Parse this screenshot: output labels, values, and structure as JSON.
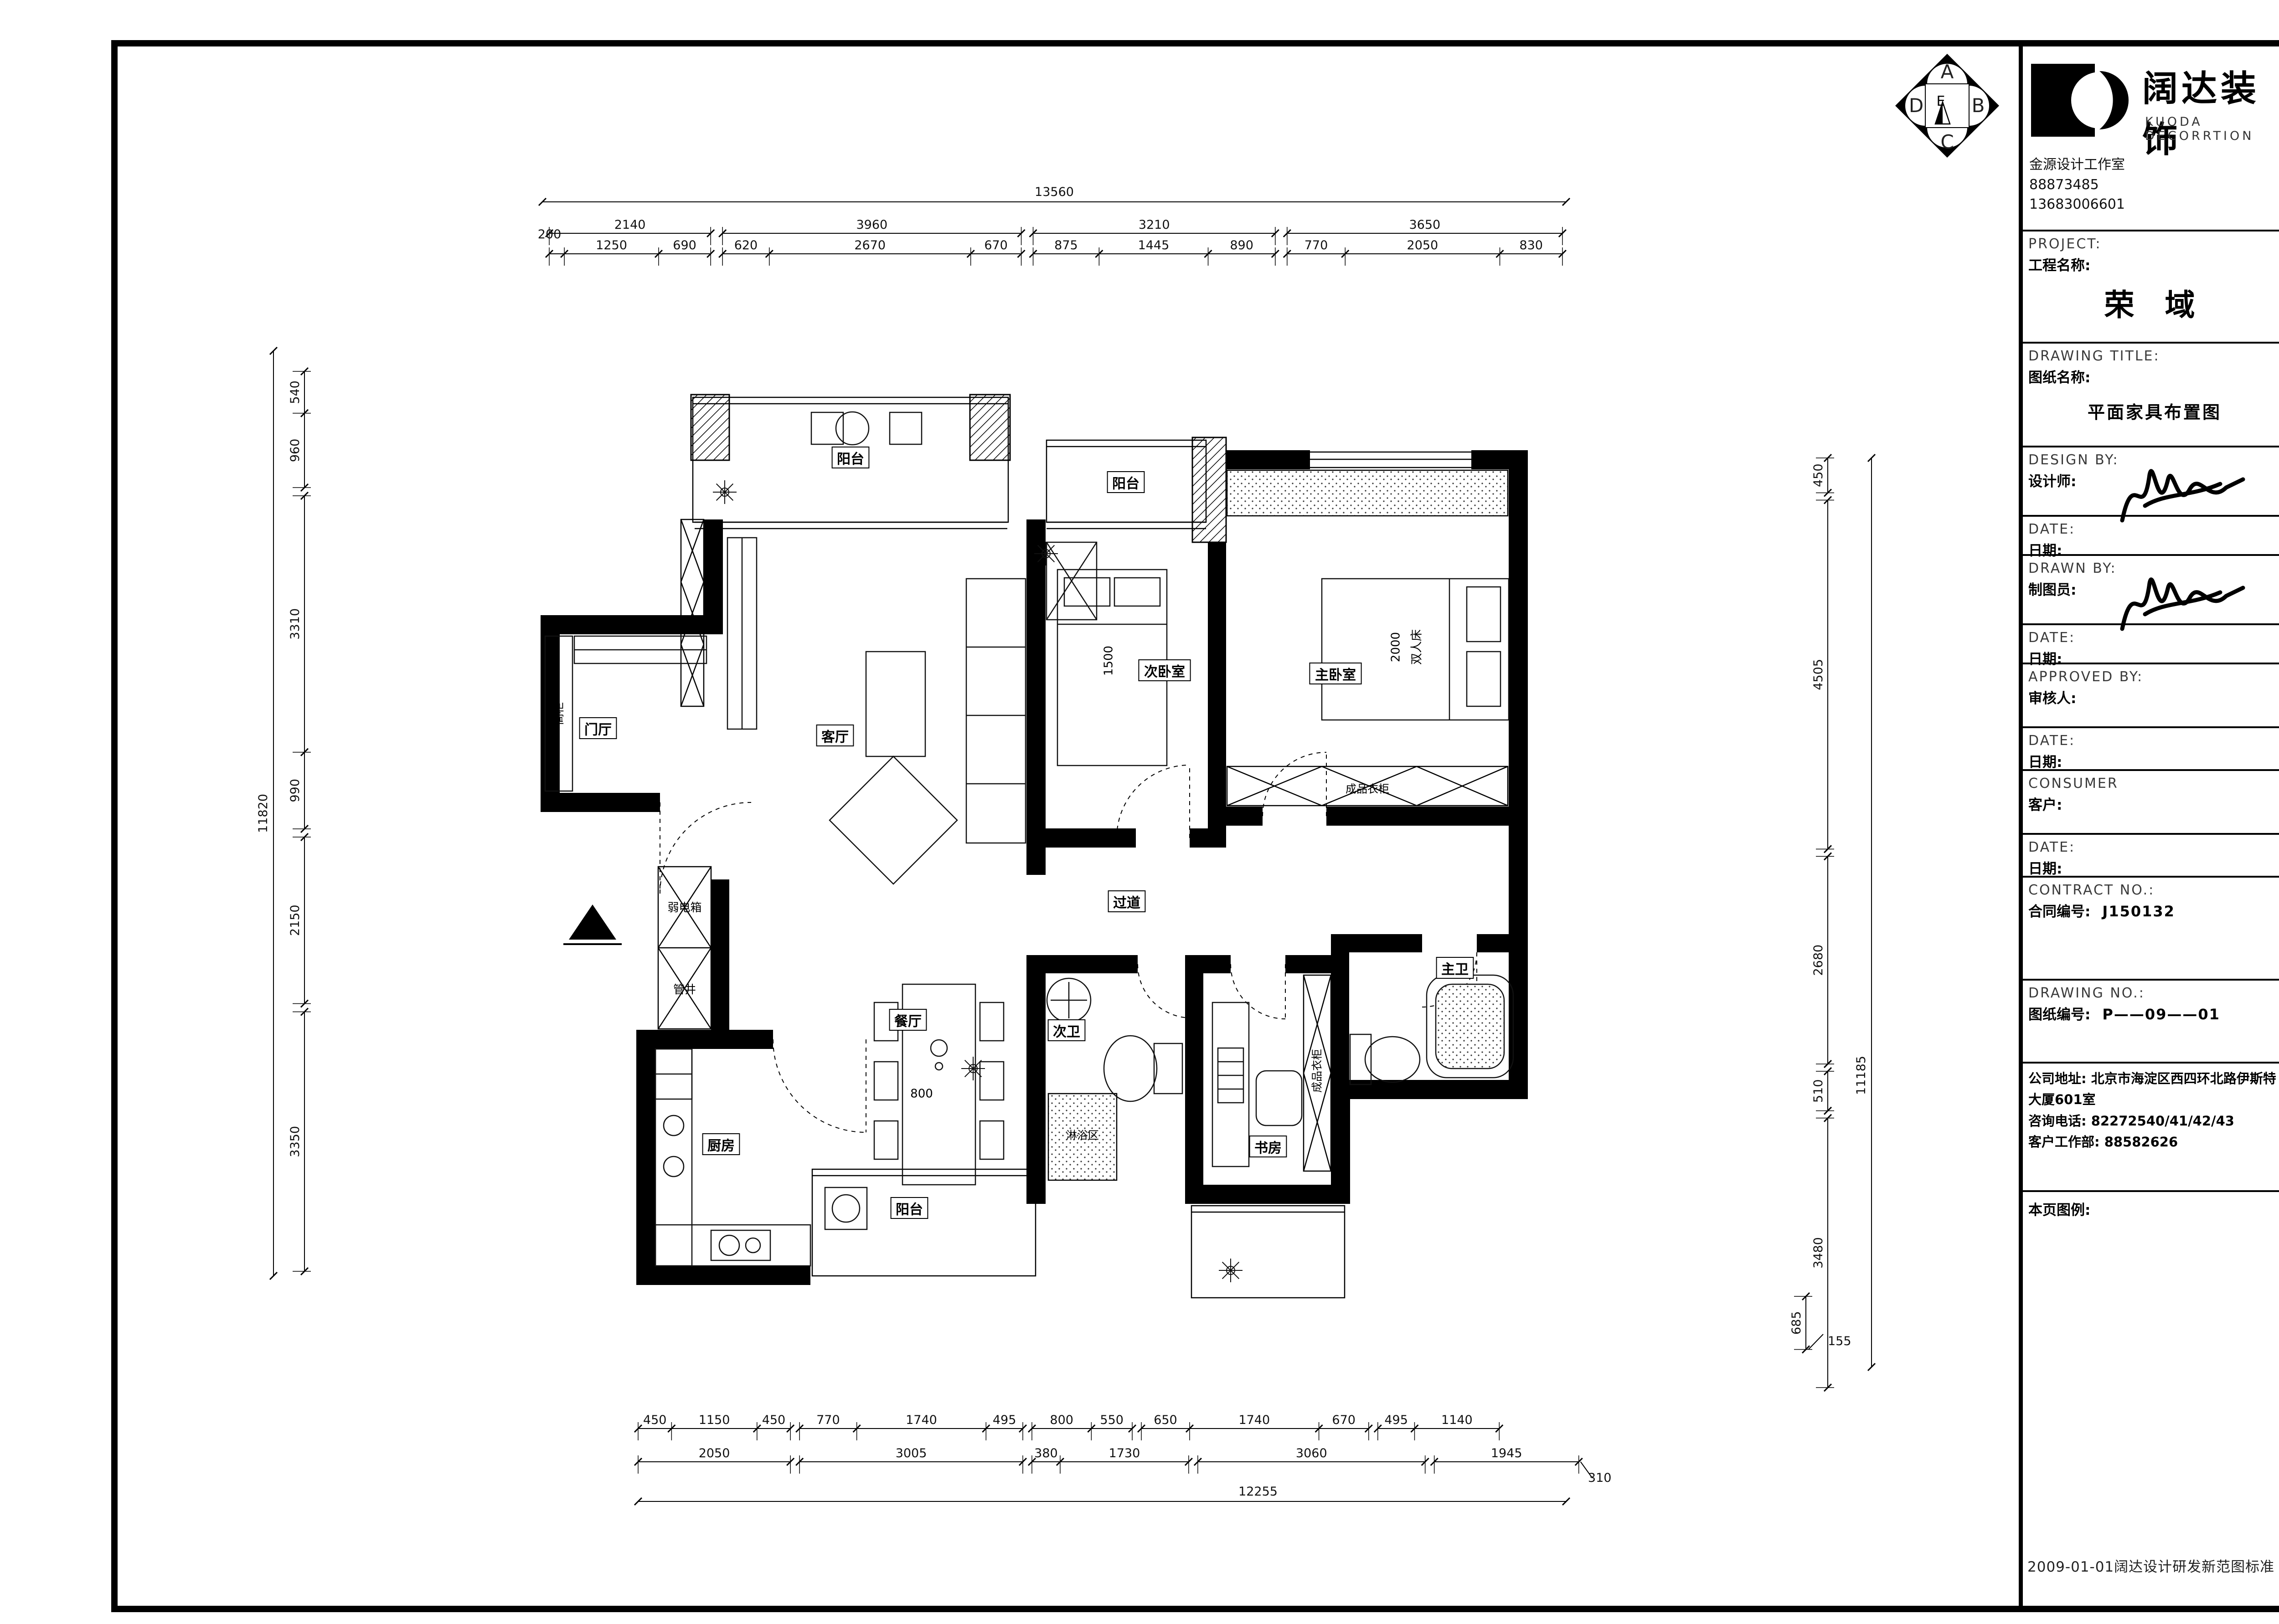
{
  "emblem": {
    "letters": [
      "A",
      "B",
      "C",
      "D"
    ],
    "center": "E"
  },
  "title_block": {
    "logo_cn": "阔达装饰",
    "logo_en": "KUODA DECORRTION",
    "studio": [
      "金源设计工作室",
      "88873485",
      "13683006601"
    ],
    "rows": [
      {
        "id": "project",
        "en": "PROJECT:",
        "cn": "工程名称:",
        "value": "荣 域"
      },
      {
        "id": "drawing-title",
        "en": "DRAWING TITLE:",
        "cn": "图纸名称:",
        "value": "平面家具布置图"
      },
      {
        "id": "design-by",
        "en": "DESIGN BY:",
        "cn": "设计师:",
        "sig": true
      },
      {
        "id": "date-1",
        "en": "DATE:",
        "cn": "日期:"
      },
      {
        "id": "drawn-by",
        "en": "DRAWN BY:",
        "cn": "制图员:",
        "sig": true
      },
      {
        "id": "date-2",
        "en": "DATE:",
        "cn": "日期:"
      },
      {
        "id": "approved-by",
        "en": "APPROVED BY:",
        "cn": "审核人:"
      },
      {
        "id": "date-3",
        "en": "DATE:",
        "cn": "日期:"
      },
      {
        "id": "consumer",
        "en": "CONSUMER",
        "cn": "客户:"
      },
      {
        "id": "date-4",
        "en": "DATE:",
        "cn": "日期:"
      },
      {
        "id": "contract-no",
        "en": "CONTRACT NO.:",
        "cn": "合同编号:",
        "inline": "J150132"
      },
      {
        "id": "drawing-no",
        "en": "DRAWING NO.:",
        "cn": "图纸编号:",
        "inline": "P——09——01"
      },
      {
        "id": "address",
        "lines": [
          "公司地址: 北京市海淀区西四环北路伊斯特",
          "大厦601室",
          "咨询电话: 82272540/41/42/43",
          "客户工作部: 88582626"
        ]
      },
      {
        "id": "legend",
        "cn": "本页图例:"
      }
    ],
    "bottom_note": "2009-01-01阔达设计研发新范图标准"
  },
  "plan": {
    "rooms": [
      {
        "id": "yangtai-1",
        "text": "阳台"
      },
      {
        "id": "yangtai-2",
        "text": "阳台"
      },
      {
        "id": "yangtai-3",
        "text": "阳台"
      },
      {
        "id": "menting",
        "text": "门厅"
      },
      {
        "id": "keting",
        "text": "客厅"
      },
      {
        "id": "ciwoshi",
        "text": "次卧室"
      },
      {
        "id": "zhuwoshi",
        "text": "主卧室"
      },
      {
        "id": "canting",
        "text": "餐厅"
      },
      {
        "id": "chufang",
        "text": "厨房"
      },
      {
        "id": "ciwei",
        "text": "次卫"
      },
      {
        "id": "zhuwei",
        "text": "主卫"
      },
      {
        "id": "shufang",
        "text": "书房"
      },
      {
        "id": "guodao",
        "text": "过道"
      },
      {
        "id": "ruodianxiang",
        "text": "弱电箱"
      },
      {
        "id": "guanjing",
        "text": "管井"
      },
      {
        "id": "linyuqu",
        "text": "淋浴区"
      }
    ],
    "annotations": [
      {
        "id": "gaogui",
        "text": "高柜"
      },
      {
        "id": "yigui-1",
        "text": "成品衣柜"
      },
      {
        "id": "yigui-2",
        "text": "成品衣柜"
      },
      {
        "id": "bed-master",
        "text": "双人床"
      },
      {
        "id": "bed-master-size",
        "text": "2000"
      },
      {
        "id": "bed2-size",
        "text": "1500"
      },
      {
        "id": "table-size",
        "text": "800"
      }
    ],
    "dims": {
      "top": {
        "overall": 13560,
        "totals": [
          2140,
          3960,
          3210,
          3650
        ],
        "subs": [
          [
            200,
            1250,
            690
          ],
          [
            620,
            2670,
            670
          ],
          [
            875,
            1445,
            890
          ],
          [
            770,
            2050,
            830
          ]
        ]
      },
      "bottom": {
        "overall": 12255,
        "row1": [
          [
            450,
            1150,
            450
          ],
          [
            770,
            1740,
            495
          ],
          [
            800,
            550
          ],
          [
            650,
            1740,
            670
          ],
          [
            495,
            1140
          ]
        ],
        "row2": [
          [
            2050
          ],
          [
            3005
          ],
          [
            380,
            1730
          ],
          [
            3060
          ],
          [
            1945
          ]
        ],
        "note": 310
      },
      "left": {
        "overall": 11820,
        "segs": [
          [
            540,
            960
          ],
          [
            3310,
            990
          ],
          [
            2150
          ],
          [
            3350
          ]
        ]
      },
      "right": {
        "overall": 11185,
        "segs": [
          [
            450
          ],
          [
            4505
          ],
          [
            2680
          ],
          [
            510
          ],
          [
            3480
          ]
        ],
        "extra": 685,
        "note": 155
      }
    }
  }
}
